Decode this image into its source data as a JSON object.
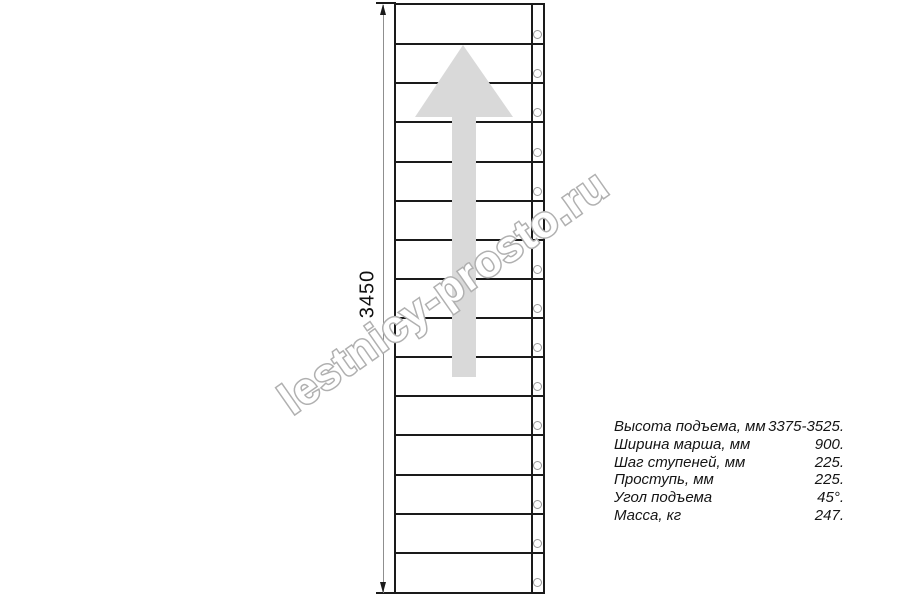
{
  "drawing": {
    "type": "straight staircase plan view",
    "dimension_label": "3450",
    "stairs": {
      "steps_count": 15
    },
    "arrow_direction": "up"
  },
  "watermark": {
    "text": "lestnicy-prosto.ru"
  },
  "specs": {
    "rows": [
      {
        "label": "Высота подъема, мм",
        "value": "3375-3525."
      },
      {
        "label": "Ширина марша, мм",
        "value": "900."
      },
      {
        "label": "Шаг ступеней, мм",
        "value": "225."
      },
      {
        "label": "Проступь, мм",
        "value": "225."
      },
      {
        "label": "Угол подъема",
        "value": "45°."
      },
      {
        "label": "Масса, кг",
        "value": "247."
      }
    ]
  },
  "colors": {
    "line": "#1a1a1a",
    "arrow": "#d9d9d9",
    "dim": "#8f8f8f",
    "circle": "#999999",
    "watermark_stroke": "#b0b0b0",
    "watermark_fill": "#ffffff"
  }
}
